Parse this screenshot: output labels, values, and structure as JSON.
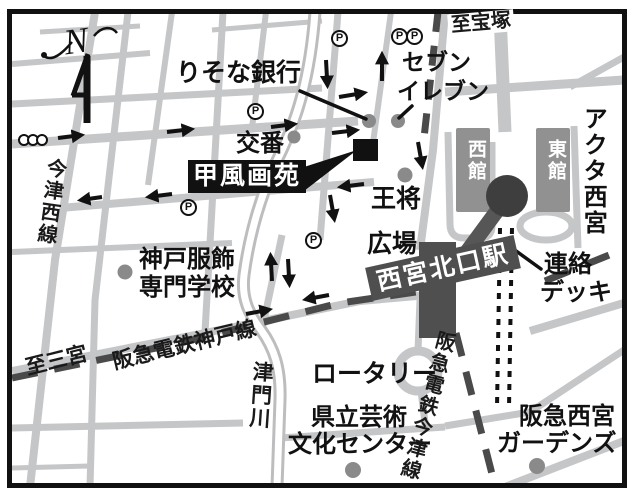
{
  "colors": {
    "road": "#c5c6c8",
    "rail_dark": "#4a4a4a",
    "building": "#919191",
    "station": "#4f4f4f",
    "dot": "#8a8a8a",
    "accent_black": "#111111"
  },
  "compass": {
    "north_letter": "N"
  },
  "parking_symbol": "P",
  "landmarks": {
    "risona_bank": "りそな銀行",
    "koban": "交番",
    "gallery": "甲風画苑",
    "seven_line1": "セブン",
    "seven_line2": "イレブン",
    "osho": "王将",
    "plaza": "広場",
    "fashion_line1": "神戸服飾",
    "fashion_line2": "専門学校",
    "station": "西宮北口駅",
    "deck_line1": "連絡",
    "deck_line2": "デッキ",
    "acta": "アクタ西宮",
    "west_building": "西館",
    "east_building": "東館",
    "rotary": "ロータリー",
    "arts_center_line1": "県立芸術",
    "arts_center_line2": "文化センター",
    "gardens_line1": "阪急西宮",
    "gardens_line2": "ガーデンズ"
  },
  "routes": {
    "imazu_nishi_line": "今津西線",
    "to_takarazuka": "至宝塚",
    "to_sannomiya": "至三宮",
    "hankyu_kobe_line": "阪急電鉄神戸線",
    "tsuto_river": "津門川",
    "hankyu_imazu_line": "阪急電鉄今津線"
  }
}
